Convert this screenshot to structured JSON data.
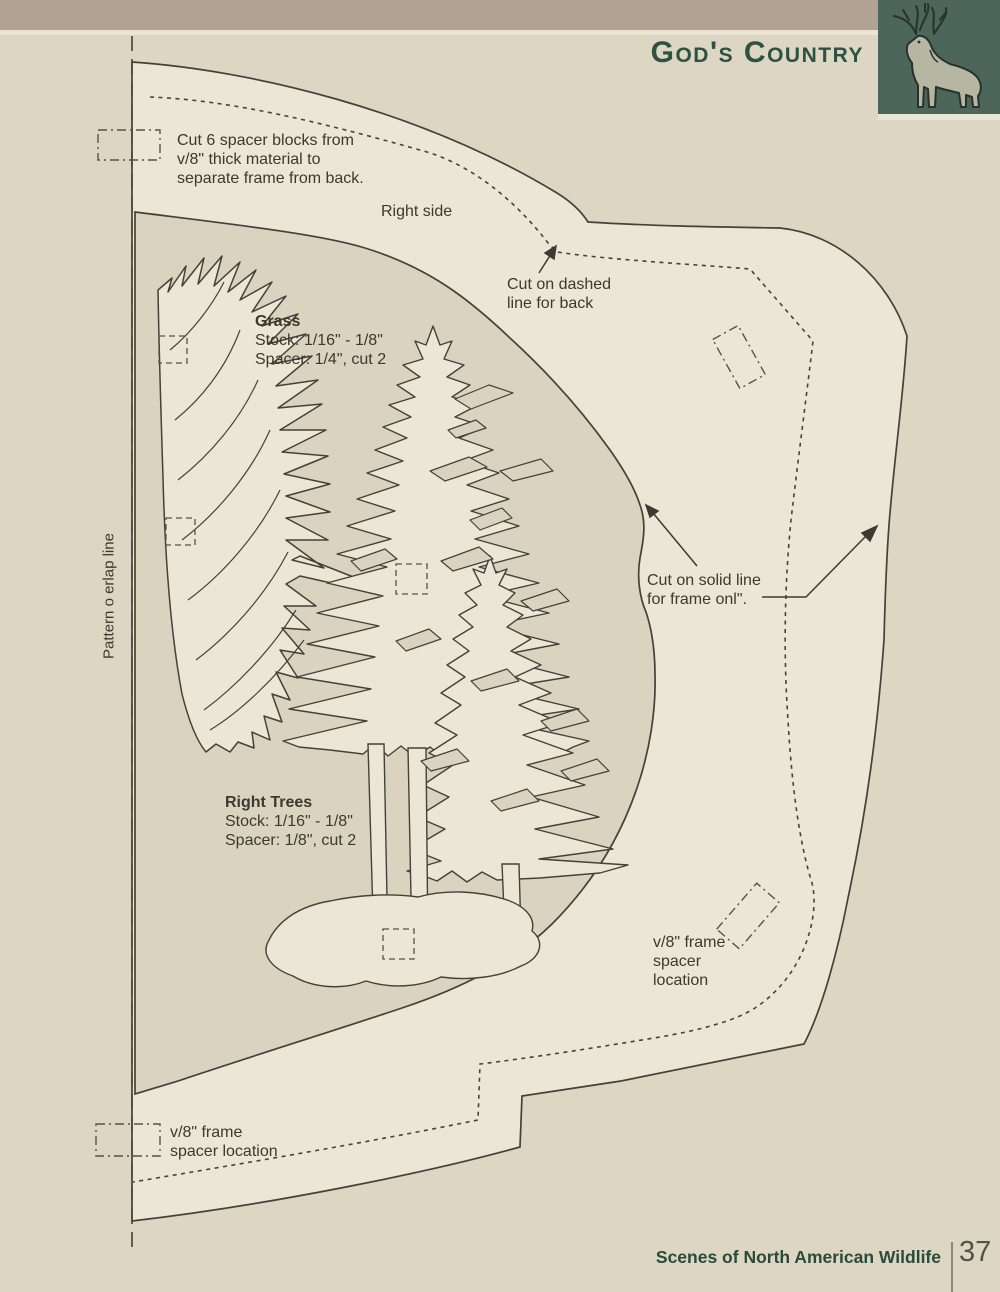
{
  "header": {
    "title": "God's Country",
    "logo": "deer-buck-illustration"
  },
  "pattern": {
    "overlap_line_label": "Pattern o erlap line",
    "right_side_label": "Right side",
    "spacer_blocks_note": {
      "line1": "Cut 6 spacer blocks from",
      "line2": "v/8\" thick material to",
      "line3": "separate frame from back."
    },
    "cut_dashed_note": {
      "line1": "Cut on dashed",
      "line2": "line for back"
    },
    "cut_solid_note": {
      "line1": "Cut on solid line",
      "line2": "for frame onl\"."
    },
    "grass_label": {
      "title": "Grass",
      "stock": "Stock: 1/16\" - 1/8\"",
      "spacer": "Spacer: 1/4\", cut 2"
    },
    "right_trees_label": {
      "title": "Right Trees",
      "stock": "Stock: 1/16\" - 1/8\"",
      "spacer": "Spacer: 1/8\", cut 2"
    },
    "frame_spacer_right": {
      "line1": "v/8\" frame",
      "line2": "spacer",
      "line3": "location"
    },
    "frame_spacer_bottom_left": {
      "line1": "v/8\" frame",
      "line2": "spacer location"
    }
  },
  "footer": {
    "book_title": "Scenes of North American Wildlife",
    "page_number": "37"
  },
  "palette": {
    "page_bg": "#dcd6c3",
    "window_bg": "#d9d3bf",
    "pattern_cream": "#ebe6d5",
    "outline": "#43423a",
    "band_tan": "#b1a292",
    "logo_green": "#4d665c",
    "deer_body": "#b6b6a2",
    "title_green": "#2d5244",
    "footer_green": "#2c4a3b",
    "page_number_gray": "#4e5447",
    "text_dark": "#3b3a30"
  }
}
